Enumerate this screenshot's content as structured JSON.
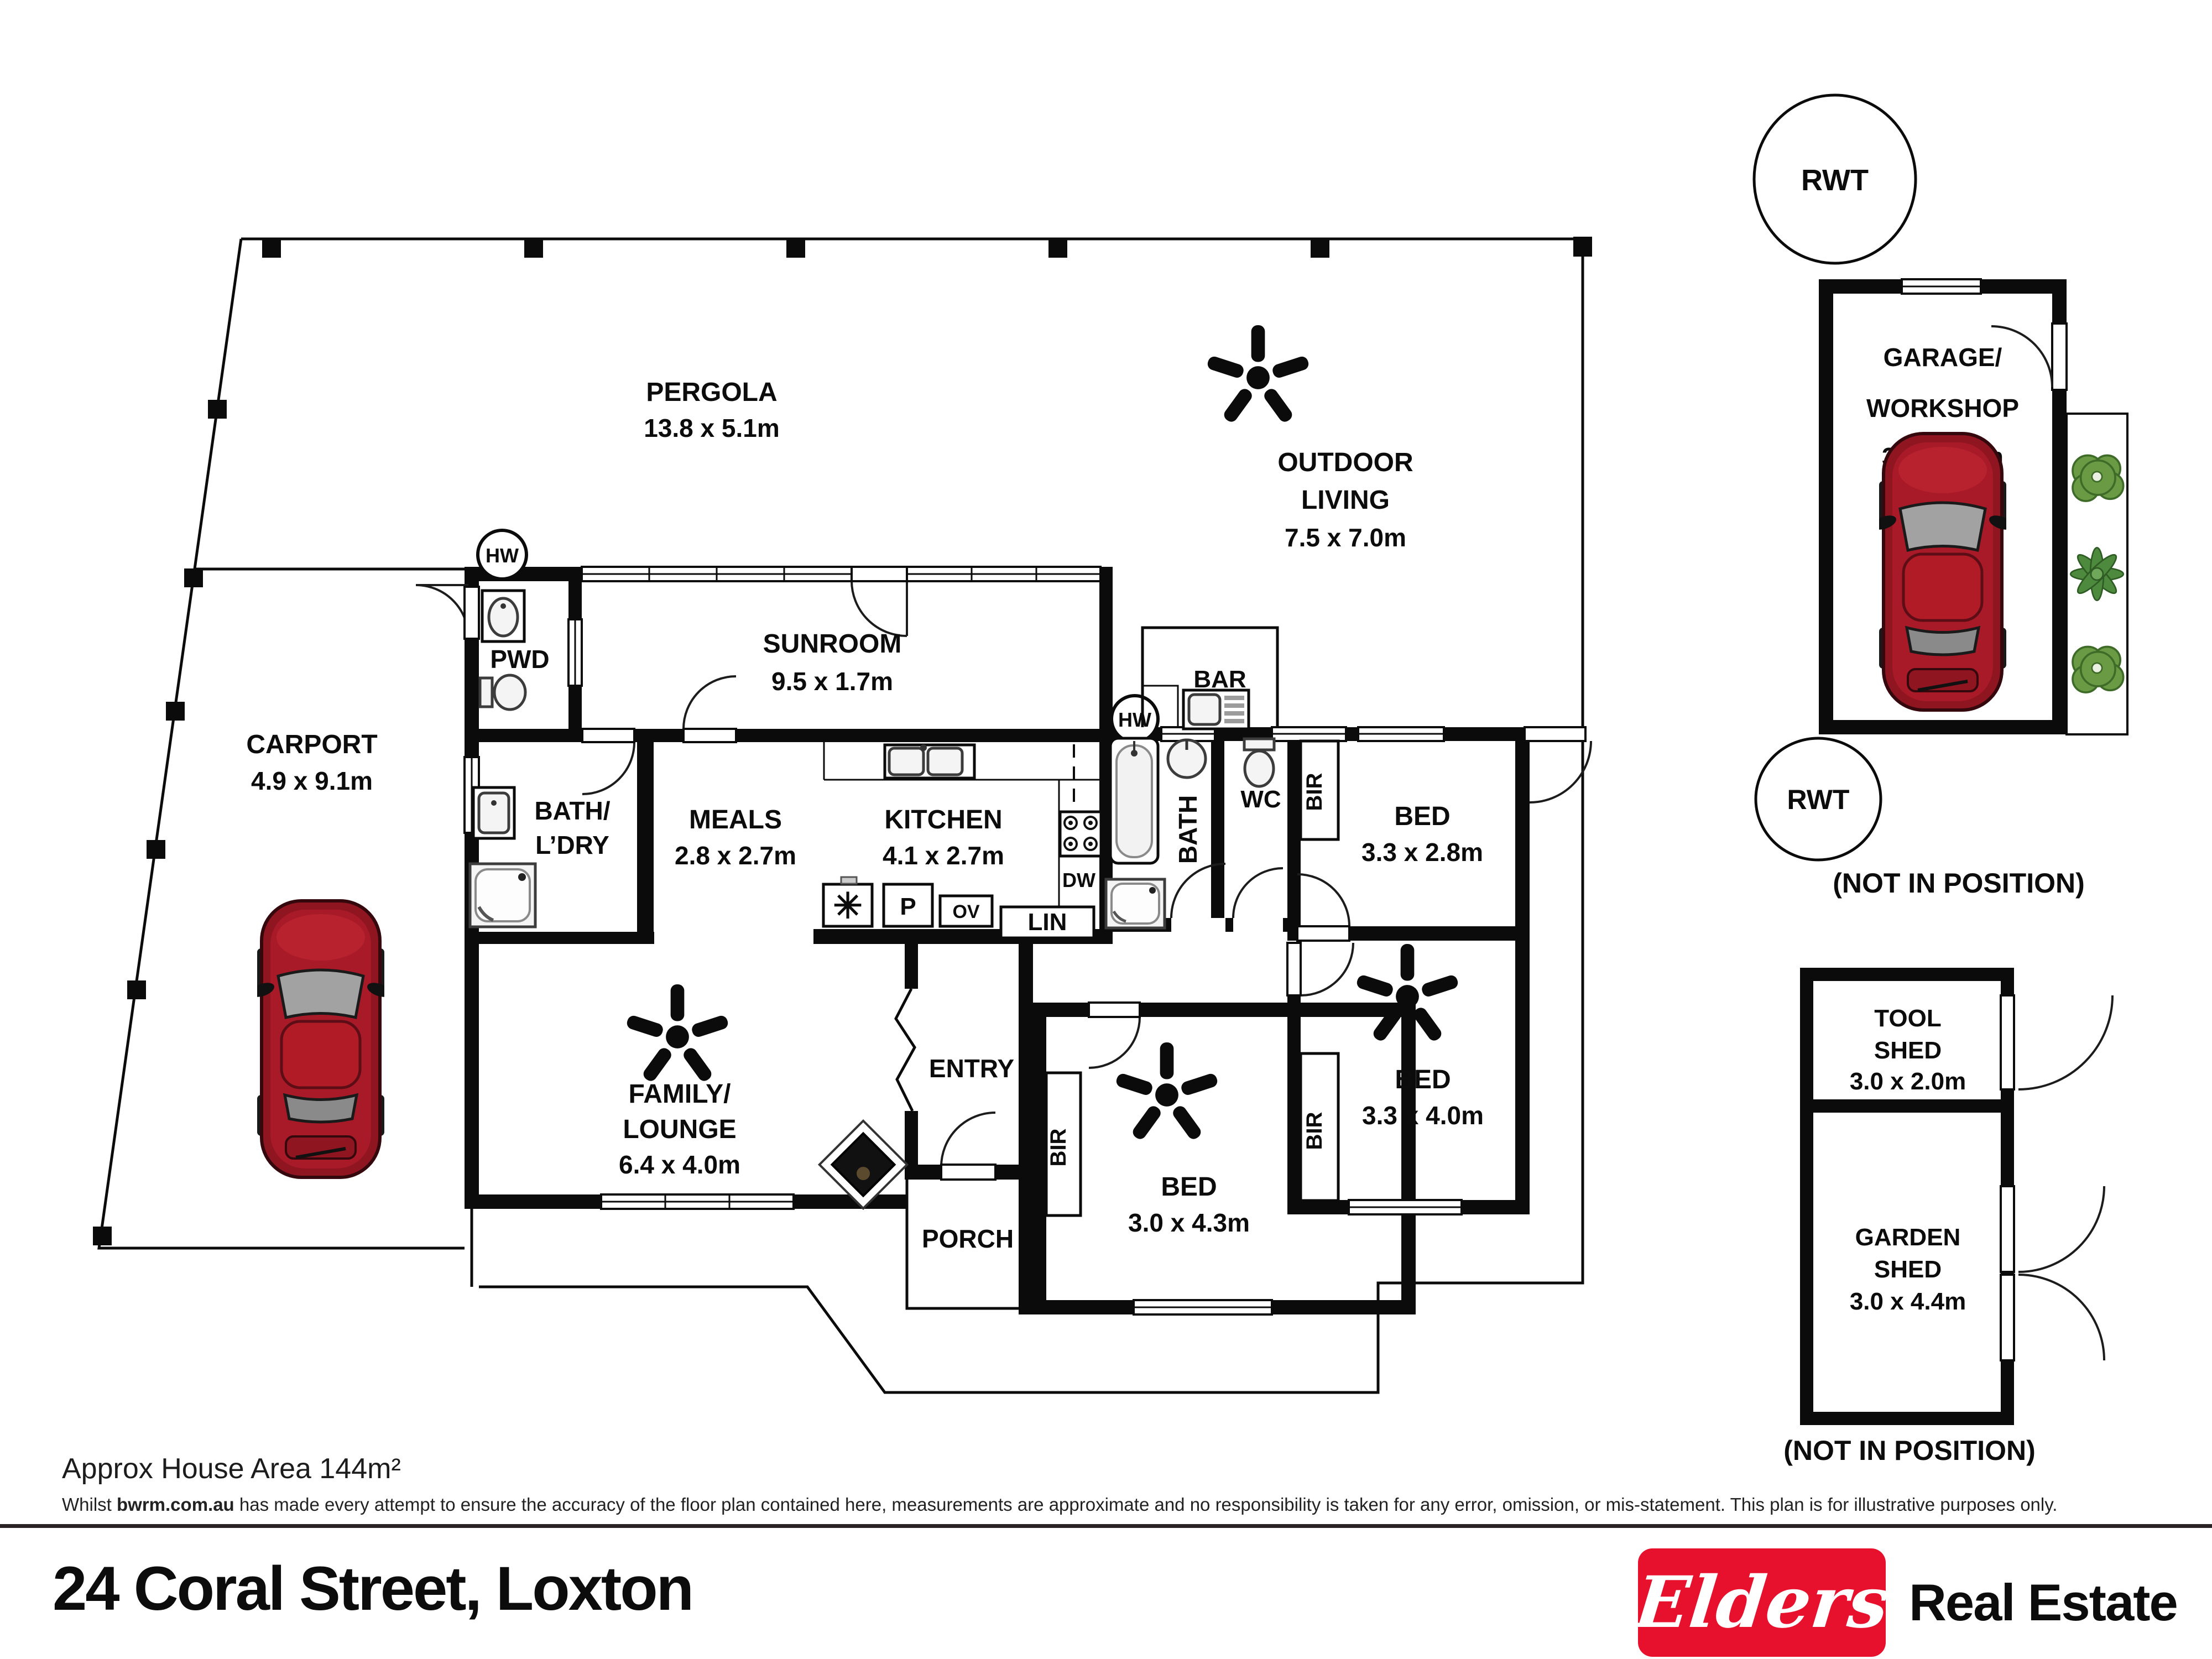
{
  "meta": {
    "accent_red": "#e8112d",
    "car_red": "#a81a28",
    "plant_green": "#6a9a44",
    "ink": "#0b0b0b"
  },
  "rooms": {
    "pergola": {
      "name": "PERGOLA",
      "dims": "13.8 x 5.1m"
    },
    "outdoor": {
      "line1": "OUTDOOR",
      "line2": "LIVING",
      "dims": "7.5 x 7.0m"
    },
    "carport": {
      "name": "CARPORT",
      "dims": "4.9 x 9.1m"
    },
    "sunroom": {
      "name": "SUNROOM",
      "dims": "9.5 x 1.7m"
    },
    "pwd": {
      "name": "PWD"
    },
    "bar": {
      "name": "BAR"
    },
    "bath_ldry": {
      "line1": "BATH/",
      "line2": "L’DRY"
    },
    "meals": {
      "name": "MEALS",
      "dims": "2.8 x 2.7m"
    },
    "kitchen": {
      "name": "KITCHEN",
      "dims": "4.1 x 2.7m"
    },
    "bath": {
      "name": "BATH"
    },
    "wc": {
      "name": "WC"
    },
    "bed1": {
      "name": "BED",
      "dims": "3.3 x 2.8m"
    },
    "bed2": {
      "name": "BED",
      "dims": "3.3 x 4.0m"
    },
    "bed3": {
      "name": "BED",
      "dims": "3.0 x 4.3m"
    },
    "family": {
      "line1": "FAMILY/",
      "line2": "LOUNGE",
      "dims": "6.4 x 4.0m"
    },
    "entry": {
      "name": "ENTRY"
    },
    "porch": {
      "name": "PORCH"
    },
    "garage": {
      "line1": "GARAGE/",
      "line2": "WORKSHOP",
      "dims": "3.5 x 6.2m"
    },
    "tool_shed": {
      "line1": "TOOL",
      "line2": "SHED",
      "dims": "3.0 x 2.0m"
    },
    "garden_shed": {
      "line1": "GARDEN",
      "line2": "SHED",
      "dims": "3.0 x 4.4m"
    }
  },
  "fixtures": {
    "hw": "HW",
    "rwt": "RWT",
    "bir": "BIR",
    "lin": "LIN",
    "dw": "DW",
    "pantry": "P",
    "oven": "OV",
    "fridge_symbol": "✳",
    "not_in_position": "(NOT IN POSITION)"
  },
  "footer": {
    "area": "Approx House Area 144m²",
    "disclaimer_pre": "Whilst ",
    "disclaimer_site": "bwrm.com.au",
    "disclaimer_post": " has made every attempt to ensure the accuracy of the floor plan contained here, measurements are approximate and no responsibility is taken for any error, omission, or mis-statement. This plan is for illustrative purposes only.",
    "address": "24 Coral Street, Loxton",
    "logo_script": "Elders",
    "logo_suffix": "Real Estate"
  }
}
